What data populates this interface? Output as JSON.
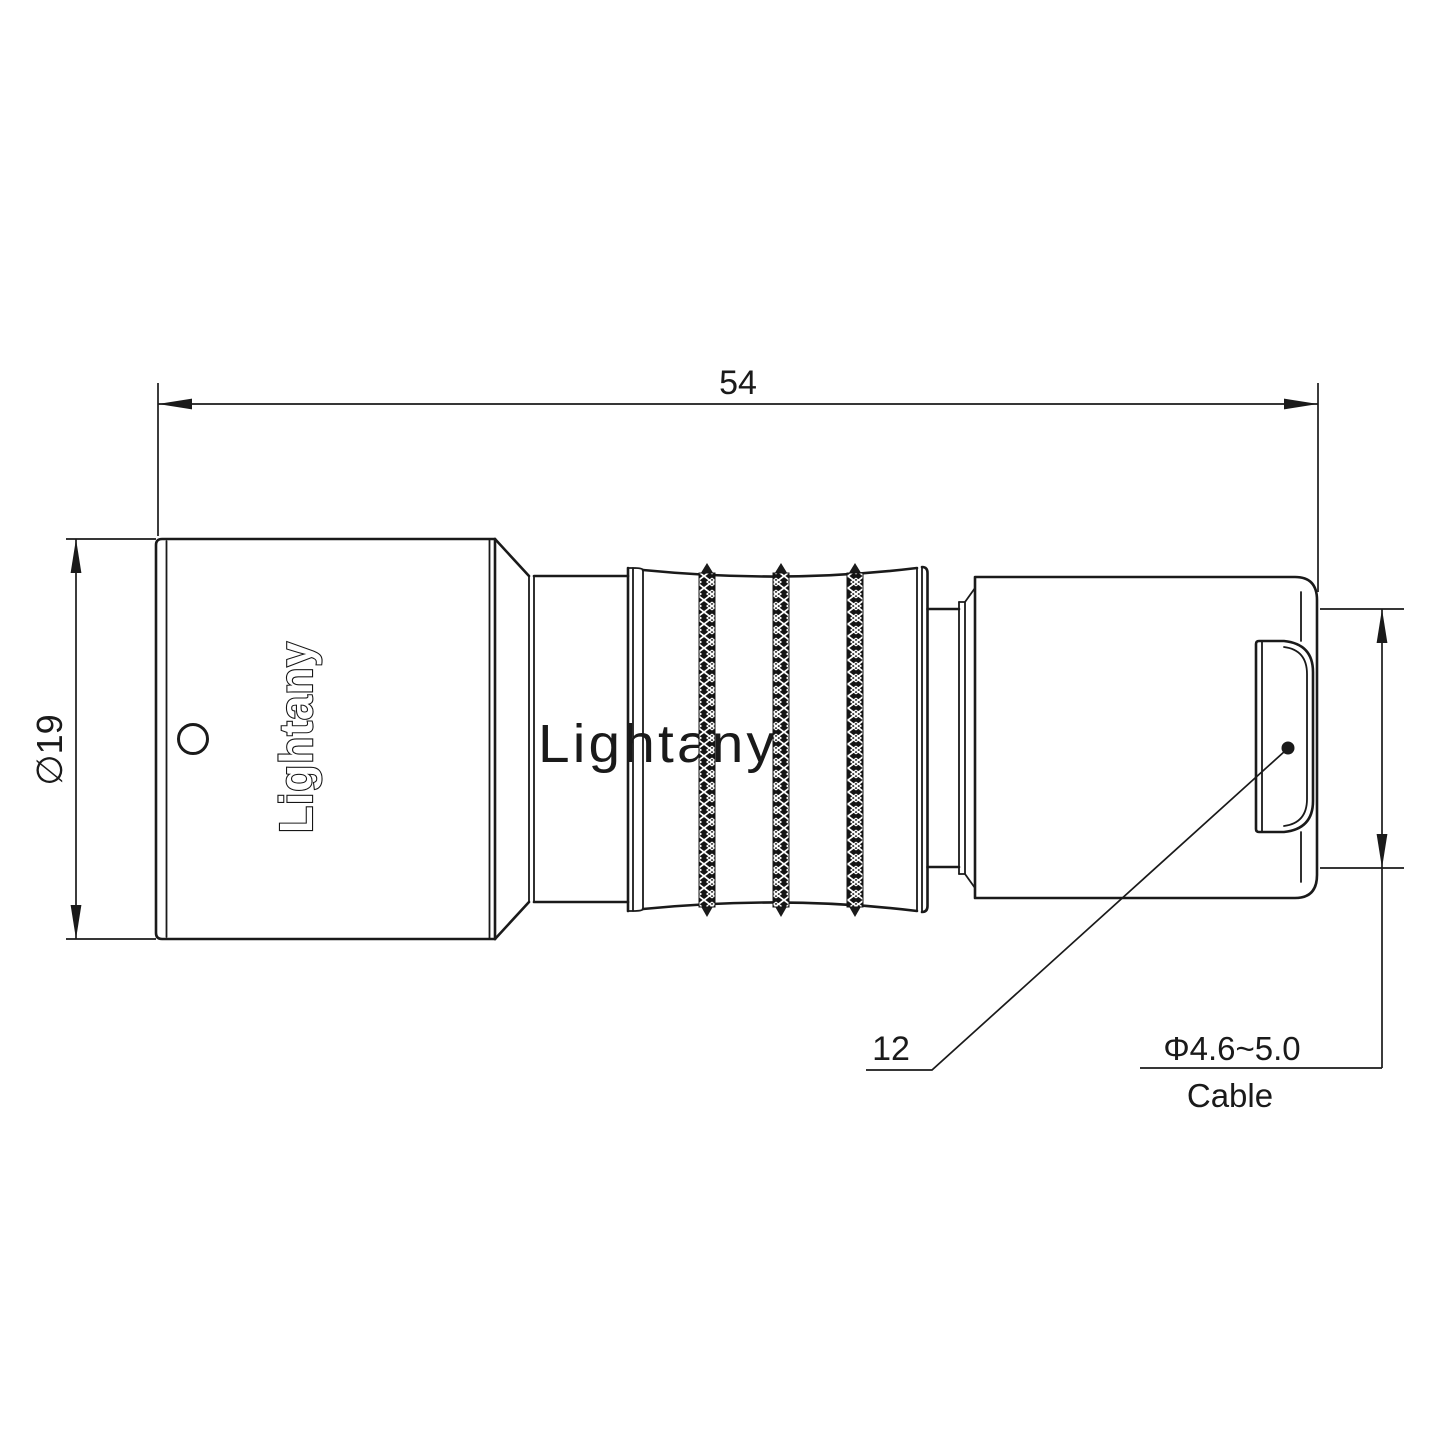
{
  "page": {
    "background": "#ffffff",
    "line_color": "#1a1a1a",
    "watermark_color": "#eda6a6"
  },
  "drawing": {
    "type": "connector-side-view-technical-drawing",
    "branding": {
      "logo": "Lightany",
      "watermark": "Lightany"
    },
    "labels": {
      "overall_length": "54",
      "shell_diameter": "∅19",
      "rear_reference": "12",
      "cable_range": "Φ4.6~5.0",
      "cable": "Cable"
    }
  }
}
